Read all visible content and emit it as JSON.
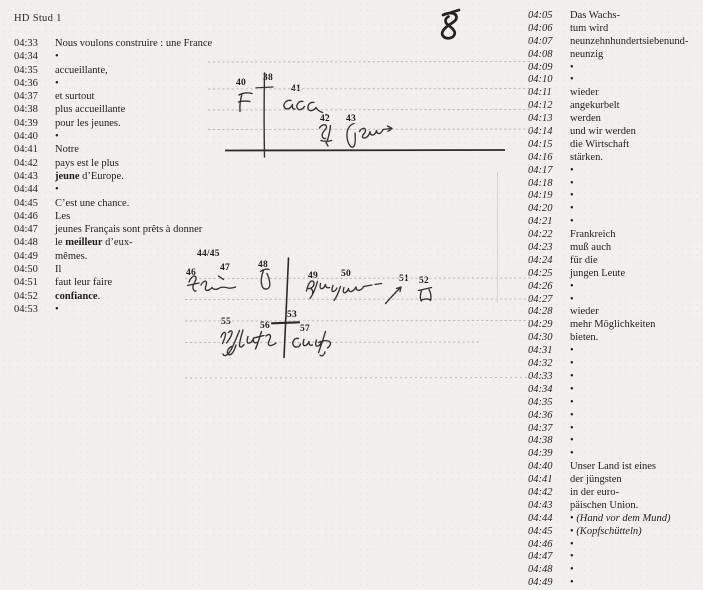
{
  "header": {
    "label": "HD Stud 1"
  },
  "page_number": "8",
  "left_column": {
    "language": "French",
    "rows": [
      {
        "time": "04:33",
        "segments": [
          {
            "text": "Nous voulons construire : une France"
          }
        ]
      },
      {
        "time": "04:34",
        "segments": [
          {
            "text": "•"
          }
        ]
      },
      {
        "time": "04:35",
        "segments": [
          {
            "text": "accueillante,"
          }
        ]
      },
      {
        "time": "04:36",
        "segments": [
          {
            "text": "•"
          }
        ]
      },
      {
        "time": "04:37",
        "segments": [
          {
            "text": "et surtout"
          }
        ]
      },
      {
        "time": "04:38",
        "segments": [
          {
            "text": "plus accueillante"
          }
        ]
      },
      {
        "time": "04:39",
        "segments": [
          {
            "text": "pour les jeunes."
          }
        ]
      },
      {
        "time": "04:40",
        "segments": [
          {
            "text": "•"
          }
        ]
      },
      {
        "time": "04:41",
        "segments": [
          {
            "text": "Notre"
          }
        ]
      },
      {
        "time": "04:42",
        "segments": [
          {
            "text": "pays est le plus"
          }
        ]
      },
      {
        "time": "04:43",
        "segments": [
          {
            "text": "jeune",
            "bold": true
          },
          {
            "text": " d’Europe."
          }
        ]
      },
      {
        "time": "04:44",
        "segments": [
          {
            "text": "•"
          }
        ]
      },
      {
        "time": "04:45",
        "segments": [
          {
            "text": "C’est une chance."
          }
        ]
      },
      {
        "time": "04:46",
        "segments": [
          {
            "text": "Les"
          }
        ]
      },
      {
        "time": "04:47",
        "segments": [
          {
            "text": "jeunes Français sont prêts à donner"
          }
        ]
      },
      {
        "time": "04:48",
        "segments": [
          {
            "text": "le "
          },
          {
            "text": "meilleur",
            "bold": true
          },
          {
            "text": " d’eux-"
          }
        ]
      },
      {
        "time": "04:49",
        "segments": [
          {
            "text": "mêmes."
          }
        ]
      },
      {
        "time": "04:50",
        "segments": [
          {
            "text": "Il"
          }
        ]
      },
      {
        "time": "04:51",
        "segments": [
          {
            "text": "faut leur faire"
          }
        ]
      },
      {
        "time": "04:52",
        "segments": [
          {
            "text": "confiance",
            "bold": true
          },
          {
            "text": "."
          }
        ]
      },
      {
        "time": "04:53",
        "segments": [
          {
            "text": "•"
          }
        ]
      }
    ]
  },
  "right_column": {
    "language": "German",
    "rows": [
      {
        "time": "04:05",
        "segments": [
          {
            "text": "Das Wachs-"
          }
        ]
      },
      {
        "time": "04:06",
        "segments": [
          {
            "text": "tum wird"
          }
        ]
      },
      {
        "time": "04:07",
        "segments": [
          {
            "text": "neunzehnhundertsiebenund-"
          }
        ]
      },
      {
        "time": "04:08",
        "segments": [
          {
            "text": "neunzig"
          }
        ]
      },
      {
        "time": "04:09",
        "segments": [
          {
            "text": "•"
          }
        ]
      },
      {
        "time": "04:10",
        "segments": [
          {
            "text": "•"
          }
        ]
      },
      {
        "time": "04:11",
        "segments": [
          {
            "text": "wieder"
          }
        ]
      },
      {
        "time": "04:12",
        "segments": [
          {
            "text": "angekurbelt"
          }
        ]
      },
      {
        "time": "04:13",
        "segments": [
          {
            "text": "werden"
          }
        ]
      },
      {
        "time": "04:14",
        "segments": [
          {
            "text": "und wir werden"
          }
        ]
      },
      {
        "time": "04:15",
        "segments": [
          {
            "text": "die Wirtschaft"
          }
        ]
      },
      {
        "time": "04:16",
        "segments": [
          {
            "text": "stärken."
          }
        ]
      },
      {
        "time": "04:17",
        "segments": [
          {
            "text": "•"
          }
        ]
      },
      {
        "time": "04:18",
        "segments": [
          {
            "text": "•"
          }
        ]
      },
      {
        "time": "04:19",
        "segments": [
          {
            "text": "•"
          }
        ]
      },
      {
        "time": "04:20",
        "segments": [
          {
            "text": "•"
          }
        ]
      },
      {
        "time": "04:21",
        "segments": [
          {
            "text": "•"
          }
        ]
      },
      {
        "time": "04:22",
        "segments": [
          {
            "text": "Frankreich"
          }
        ]
      },
      {
        "time": "04:23",
        "segments": [
          {
            "text": "muß auch"
          }
        ]
      },
      {
        "time": "04:24",
        "segments": [
          {
            "text": "für die"
          }
        ]
      },
      {
        "time": "04:25",
        "segments": [
          {
            "text": "jungen Leute"
          }
        ]
      },
      {
        "time": "04:26",
        "segments": [
          {
            "text": "•"
          }
        ]
      },
      {
        "time": "04:27",
        "segments": [
          {
            "text": "•"
          }
        ]
      },
      {
        "time": "04:28",
        "segments": [
          {
            "text": "wieder"
          }
        ]
      },
      {
        "time": "04:29",
        "segments": [
          {
            "text": "mehr Möglichkeiten"
          }
        ]
      },
      {
        "time": "04:30",
        "segments": [
          {
            "text": "bieten."
          }
        ]
      },
      {
        "time": "04:31",
        "segments": [
          {
            "text": "•"
          }
        ]
      },
      {
        "time": "04:32",
        "segments": [
          {
            "text": "•"
          }
        ]
      },
      {
        "time": "04:33",
        "segments": [
          {
            "text": "•"
          }
        ]
      },
      {
        "time": "04:34",
        "segments": [
          {
            "text": "•"
          }
        ]
      },
      {
        "time": "04:35",
        "segments": [
          {
            "text": "•"
          }
        ]
      },
      {
        "time": "04:36",
        "segments": [
          {
            "text": "•"
          }
        ]
      },
      {
        "time": "04:37",
        "segments": [
          {
            "text": "•"
          }
        ]
      },
      {
        "time": "04:38",
        "segments": [
          {
            "text": "•"
          }
        ]
      },
      {
        "time": "04:39",
        "segments": [
          {
            "text": "•"
          }
        ]
      },
      {
        "time": "04:40",
        "segments": [
          {
            "text": "Unser Land ist eines"
          }
        ]
      },
      {
        "time": "04:41",
        "segments": [
          {
            "text": "der jüngsten"
          }
        ]
      },
      {
        "time": "04:42",
        "segments": [
          {
            "text": "in der euro-"
          }
        ]
      },
      {
        "time": "04:43",
        "segments": [
          {
            "text": "päischen Union."
          }
        ]
      },
      {
        "time": "04:44",
        "segments": [
          {
            "text": "• "
          },
          {
            "text": "(Hand vor dem Mund)",
            "italic": true
          }
        ]
      },
      {
        "time": "04:45",
        "segments": [
          {
            "text": "• "
          },
          {
            "text": "(Kopfschütteln)",
            "italic": true
          }
        ]
      },
      {
        "time": "04:46",
        "segments": [
          {
            "text": "•"
          }
        ]
      },
      {
        "time": "04:47",
        "segments": [
          {
            "text": "•"
          }
        ]
      },
      {
        "time": "04:48",
        "segments": [
          {
            "text": "•"
          }
        ]
      },
      {
        "time": "04:49",
        "segments": [
          {
            "text": "•"
          }
        ]
      }
    ]
  },
  "notation": {
    "labels": [
      {
        "text": "40",
        "x": 236,
        "y": 78
      },
      {
        "text": "38",
        "x": 263,
        "y": 73
      },
      {
        "text": "41",
        "x": 291,
        "y": 84
      },
      {
        "text": "42",
        "x": 320,
        "y": 114
      },
      {
        "text": "43",
        "x": 346,
        "y": 114
      },
      {
        "text": "44/45",
        "x": 197,
        "y": 249
      },
      {
        "text": "46",
        "x": 186,
        "y": 268
      },
      {
        "text": "47",
        "x": 220,
        "y": 263
      },
      {
        "text": "48",
        "x": 258,
        "y": 260
      },
      {
        "text": "49",
        "x": 308,
        "y": 271
      },
      {
        "text": "50",
        "x": 341,
        "y": 269
      },
      {
        "text": "51",
        "x": 399,
        "y": 274
      },
      {
        "text": "52",
        "x": 419,
        "y": 276
      },
      {
        "text": "53",
        "x": 287,
        "y": 310
      },
      {
        "text": "55",
        "x": 221,
        "y": 317
      },
      {
        "text": "56",
        "x": 260,
        "y": 321
      },
      {
        "text": "57",
        "x": 300,
        "y": 324
      }
    ],
    "handwriting_transcripts": [
      {
        "name": "hw-letter-f",
        "transcript": "F"
      },
      {
        "name": "hw-acc",
        "transcript": "acc."
      },
      {
        "name": "hw-plus-jeune",
        "transcript": "plus jeune"
      },
      {
        "name": "hw-il-faut",
        "transcript": "il faut"
      },
      {
        "name": "hw-conf",
        "transcript": "conf"
      }
    ]
  }
}
